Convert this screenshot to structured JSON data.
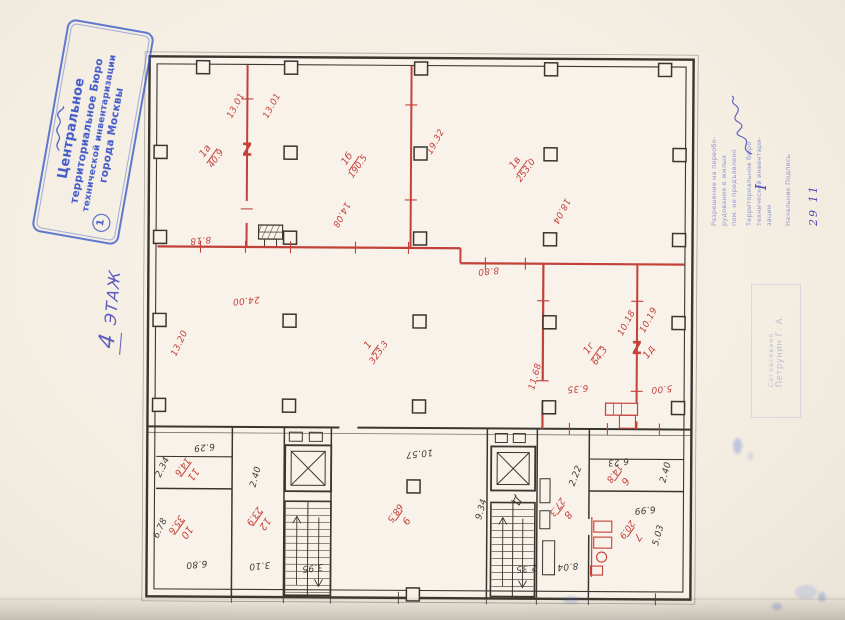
{
  "colors": {
    "red": "#c2423a",
    "ink": "#3f3c35",
    "stamp_blue": "#2f4ac6",
    "hand_blue": "#4a49bb"
  },
  "floor_note": {
    "number": "4",
    "word": "ЭТАЖ"
  },
  "stamps": {
    "bti": {
      "badge": "1",
      "lines": [
        "Центральное",
        "территориальное Бюро",
        "технической инвентаризации",
        "города Москвы"
      ]
    },
    "permit": {
      "roman": "I",
      "date": "29 11",
      "lines": [
        "Разрешение на переобо-",
        "рудование в жилых",
        "пом. не предъявлено",
        "Территориальное бюро",
        "технической инвентари-",
        "зации",
        "Начальник        Подпись"
      ]
    },
    "approval": {
      "lines": [
        "Согласовано",
        "Петрунин Г. А."
      ]
    }
  },
  "plan": {
    "rooms": [
      {
        "num": "1а",
        "area": "40.9",
        "x": 68,
        "y": 105,
        "r": -55
      },
      {
        "num": "1б",
        "area": "190.5",
        "x": 210,
        "y": 112,
        "r": -55
      },
      {
        "num": "1в",
        "area": "253.0",
        "x": 378,
        "y": 115,
        "r": -55
      },
      {
        "num": "1",
        "area": "323.3",
        "x": 232,
        "y": 298,
        "r": -55
      },
      {
        "num": "1г",
        "area": "64.3",
        "x": 453,
        "y": 300,
        "r": -55
      },
      {
        "num": "1д",
        "area": "",
        "x": 508,
        "y": 300,
        "r": -55
      },
      {
        "num": "11",
        "area": "14.6",
        "x": 50,
        "y": 423,
        "r": 125
      },
      {
        "num": "10",
        "area": "35.6",
        "x": 44,
        "y": 481,
        "r": 125
      },
      {
        "num": "12",
        "area": "23.9",
        "x": 122,
        "y": 472,
        "r": 125
      },
      {
        "num": "9",
        "area": "68.5",
        "x": 263,
        "y": 468,
        "r": 125
      },
      {
        "num": "8",
        "area": "27.3",
        "x": 425,
        "y": 461,
        "r": 125
      },
      {
        "num": "7",
        "area": "20.9",
        "x": 495,
        "y": 483,
        "r": 125
      },
      {
        "num": "6",
        "area": "14.8",
        "x": 482,
        "y": 427,
        "r": 125
      }
    ],
    "dimensions": [
      {
        "v": "13.01",
        "x": 95,
        "y": 57,
        "r": -62
      },
      {
        "v": "13.01",
        "x": 131,
        "y": 57,
        "r": -62
      },
      {
        "v": "19.32",
        "x": 295,
        "y": 92,
        "r": -62
      },
      {
        "v": "14.08",
        "x": 200,
        "y": 165,
        "r": 118
      },
      {
        "v": "18.04",
        "x": 420,
        "y": 160,
        "r": 118
      },
      {
        "v": "8.18",
        "x": 60,
        "y": 191,
        "r": 174
      },
      {
        "v": "8.80",
        "x": 348,
        "y": 220,
        "r": 174
      },
      {
        "v": "24.00",
        "x": 106,
        "y": 251,
        "r": 174
      },
      {
        "v": "13.20",
        "x": 40,
        "y": 295,
        "r": -65
      },
      {
        "v": "11.68",
        "x": 396,
        "y": 326,
        "r": -75
      },
      {
        "v": "10.18",
        "x": 487,
        "y": 272,
        "r": -62
      },
      {
        "v": "10.19",
        "x": 509,
        "y": 269,
        "r": -62
      },
      {
        "v": "6.35",
        "x": 438,
        "y": 337,
        "r": 174
      },
      {
        "v": "5.00",
        "x": 522,
        "y": 337,
        "r": 174
      },
      {
        "v": "2.34",
        "x": 24,
        "y": 419,
        "r": -65,
        "c": "b"
      },
      {
        "v": "6.29",
        "x": 65,
        "y": 398,
        "r": 174,
        "c": "b"
      },
      {
        "v": "2.40",
        "x": 117,
        "y": 428,
        "r": -75,
        "c": "b"
      },
      {
        "v": "6.78",
        "x": 22,
        "y": 480,
        "r": -65,
        "c": "b"
      },
      {
        "v": "6.80",
        "x": 58,
        "y": 515,
        "r": 174,
        "c": "b"
      },
      {
        "v": "3.10",
        "x": 121,
        "y": 516,
        "r": 174,
        "c": "b"
      },
      {
        "v": "3.95",
        "x": 174,
        "y": 518,
        "r": 174,
        "c": "b"
      },
      {
        "v": "10.57",
        "x": 280,
        "y": 403,
        "r": 174,
        "c": "b"
      },
      {
        "v": "9.34",
        "x": 343,
        "y": 459,
        "r": -75,
        "c": "b"
      },
      {
        "v": "2.35",
        "x": 388,
        "y": 517,
        "r": 174,
        "c": "b"
      },
      {
        "v": "8.04",
        "x": 429,
        "y": 515,
        "r": 174,
        "c": "b"
      },
      {
        "v": "2.22",
        "x": 437,
        "y": 425,
        "r": -70,
        "c": "b"
      },
      {
        "v": "6.23",
        "x": 479,
        "y": 410,
        "r": 174,
        "c": "b"
      },
      {
        "v": "6.99",
        "x": 506,
        "y": 458,
        "r": 174,
        "c": "b"
      },
      {
        "v": "2.40",
        "x": 527,
        "y": 421,
        "r": -75,
        "c": "b"
      },
      {
        "v": "5.03",
        "x": 520,
        "y": 484,
        "r": -75,
        "c": "b"
      },
      {
        "v": "Д",
        "x": 378,
        "y": 450,
        "r": 115,
        "c": "b",
        "s": 11
      }
    ],
    "breaks": [
      {
        "x": 106,
        "y": 102
      },
      {
        "x": 497,
        "y": 298
      }
    ]
  }
}
